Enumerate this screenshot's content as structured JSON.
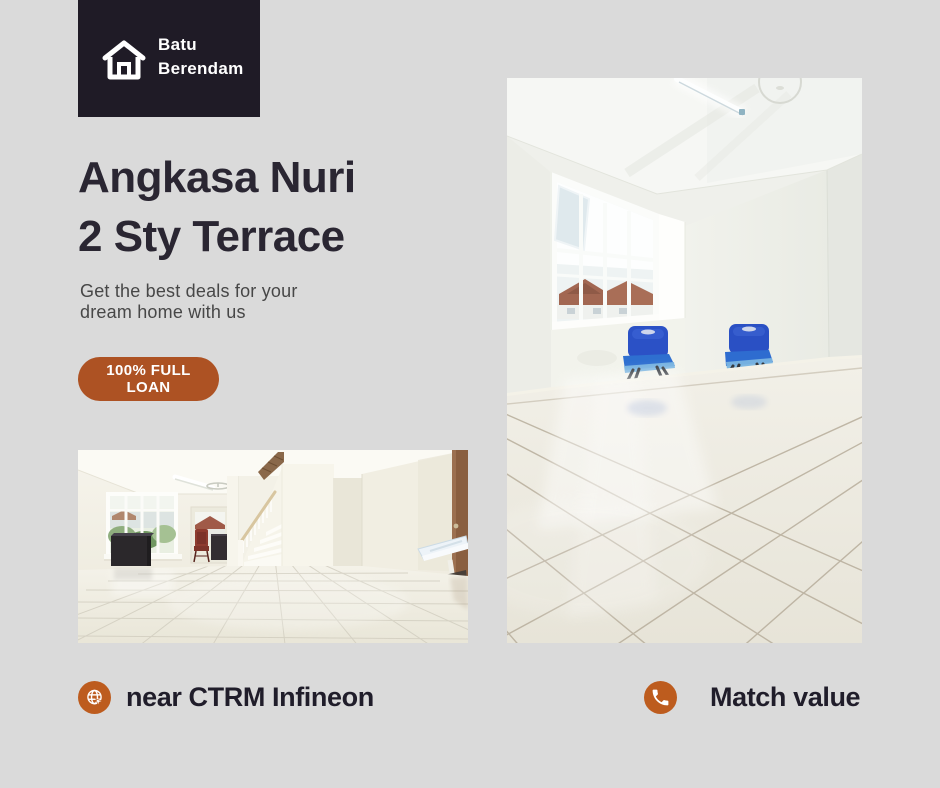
{
  "page": {
    "background": "#dadada",
    "accent_orange": "#ad5223",
    "accent_circle": "#bd5c1e",
    "logo_background": "#1f1b26",
    "text_dark": "#2a2632"
  },
  "logo": {
    "icon": "house-icon",
    "line1": "Batu",
    "line2": "Berendam"
  },
  "headline": {
    "line1": "Angkasa Nuri",
    "line2": "2 Sty Terrace"
  },
  "subtitle": {
    "line1": "Get the best deals for your",
    "line2": "dream home with us"
  },
  "badge": {
    "label": "100% FULL LOAN"
  },
  "features": [
    {
      "icon": "globe-icon",
      "label": "near CTRM Infineon"
    },
    {
      "icon": "phone-icon",
      "label": "Match value"
    }
  ],
  "photos": [
    {
      "id": "living-room-staircase",
      "description": "Empty living room with staircase, window, dark cabinet, red chair and wall sink"
    },
    {
      "id": "room-blue-chairs",
      "description": "Empty tiled room with large window, fluorescent light and two blue chairs"
    }
  ]
}
